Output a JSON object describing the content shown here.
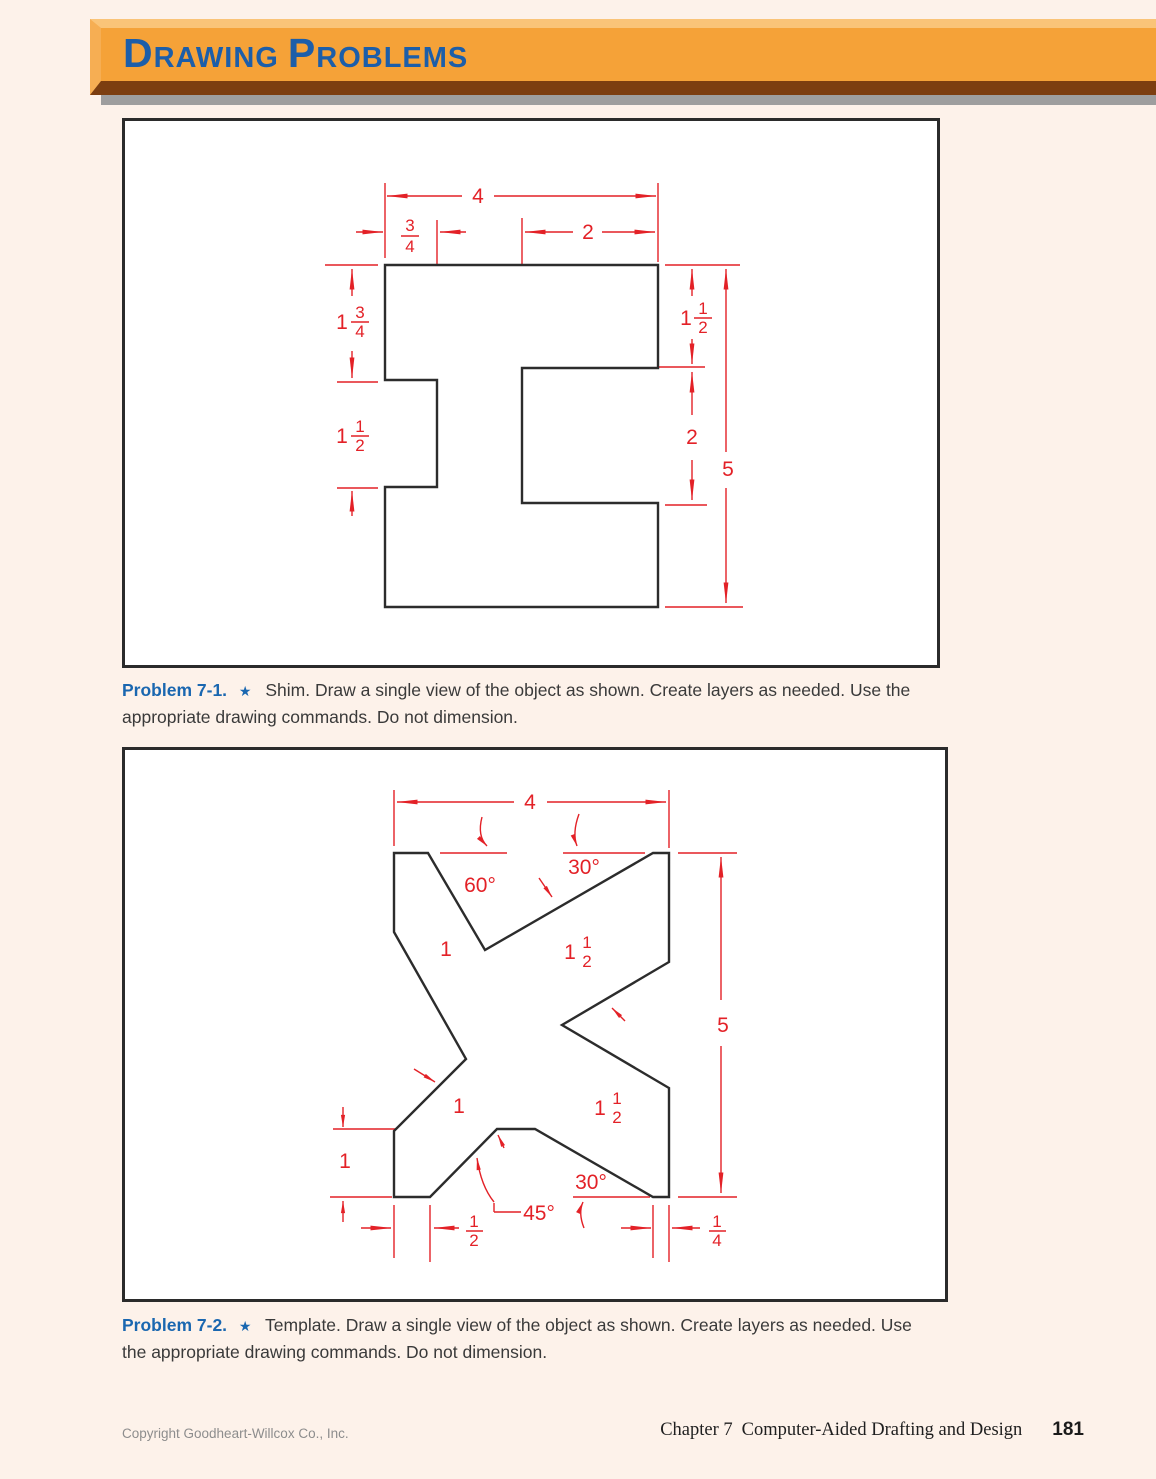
{
  "header": {
    "title": "Drawing Problems"
  },
  "figure1": {
    "caption": {
      "label": "Problem 7-1.",
      "star": "★",
      "text": "Shim. Draw a single view of the object as shown. Create layers as needed. Use the appropriate drawing commands. Do not dimension."
    },
    "dims": {
      "overall_width": "4",
      "notch_depth": {
        "num": "3",
        "den": "4"
      },
      "top_right_width": "2",
      "left_upper_height": {
        "whole": "1",
        "num": "3",
        "den": "4"
      },
      "left_notch_height": {
        "whole": "1",
        "num": "1",
        "den": "2"
      },
      "right_arm_height": {
        "whole": "1",
        "num": "1",
        "den": "2"
      },
      "right_notch_height": "2",
      "overall_height": "5"
    }
  },
  "figure2": {
    "caption": {
      "label": "Problem 7-2.",
      "star": "★",
      "text": "Template. Draw a single view of the object as shown. Create layers as needed. Use the appropriate drawing commands. Do not dimension."
    },
    "dims": {
      "overall_width": "4",
      "angle_60": "60°",
      "angle_30_top": "30°",
      "top_left_seg": "1",
      "top_diag": {
        "whole": "1",
        "num": "1",
        "den": "2"
      },
      "overall_height": "5",
      "mid_left_seg": "1",
      "bottom_diag": {
        "whole": "1",
        "num": "1",
        "den": "2"
      },
      "angle_30_bottom": "30°",
      "angle_45": "45°",
      "left_height": "1",
      "bottom_left_offset": {
        "num": "1",
        "den": "2"
      },
      "bottom_right_offset": {
        "num": "1",
        "den": "4"
      }
    }
  },
  "footer": {
    "copyright": "Copyright Goodheart-Willcox Co., Inc.",
    "chapter_label": "Chapter 7",
    "chapter_title": "Computer-Aided Drafting and Design",
    "page_number": "181"
  }
}
